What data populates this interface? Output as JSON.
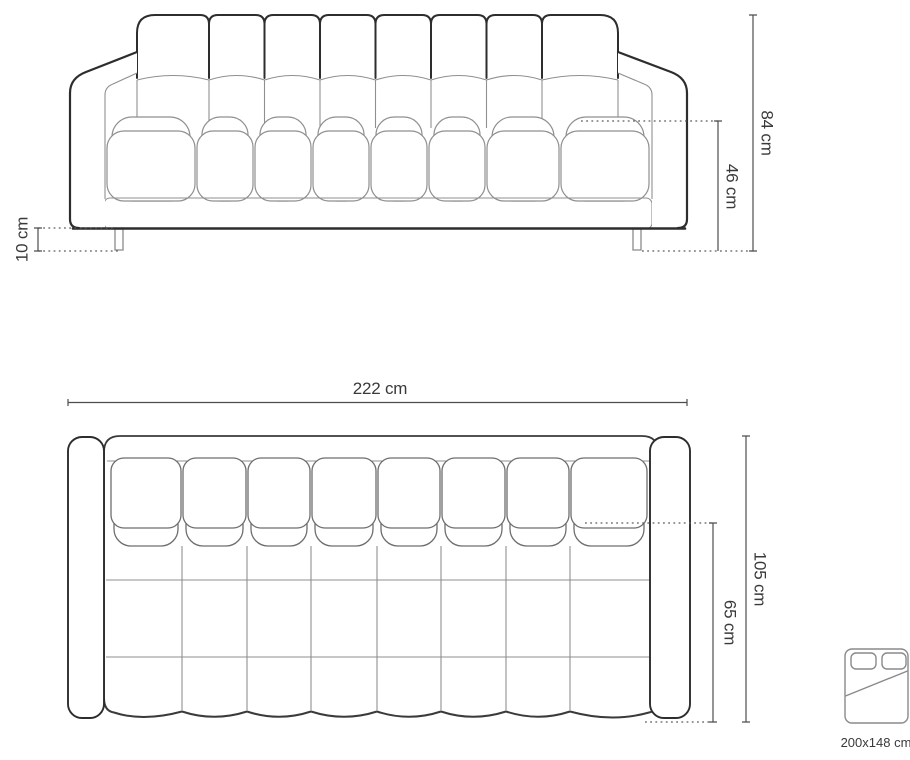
{
  "front_view": {
    "overall_height": "84 cm",
    "seat_height": "46 cm",
    "leg_height": "10 cm"
  },
  "top_view": {
    "overall_width": "222 cm",
    "overall_depth": "105 cm",
    "seat_depth": "65 cm"
  },
  "sleeping_function": {
    "bed_size": "200x148 cm"
  },
  "colors": {
    "background": "#ffffff",
    "outline_dark": "#2d2d2d",
    "seam_gray": "#8f8f8f",
    "dimension_line": "#4d4d4d",
    "label_text": "#3a3a3a"
  }
}
